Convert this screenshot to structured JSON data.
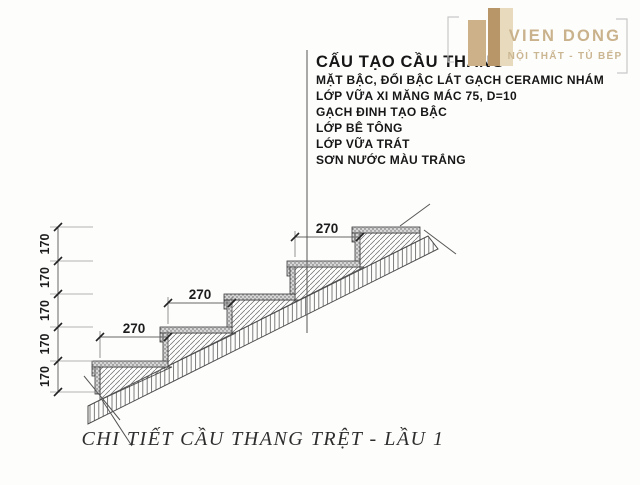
{
  "header": {
    "title": "CẤU TẠO CẦU THANG",
    "spec_lines": [
      "MẶT BẬC, ĐỐI BẬC LÁT GẠCH CERAMIC NHÁM",
      "LỚP VỮA XI MĂNG MÁC 75, D=10",
      "GẠCH ĐINH TẠO BẬC",
      "LỚP BÊ TÔNG",
      "LỚP VỮA TRÁT",
      "SƠN NƯỚC MÀU TRẮNG"
    ]
  },
  "logo": {
    "name": "VIEN DONG",
    "tagline": "NỘI THẤT - TỦ BẾP"
  },
  "dimensions": {
    "tread_label": "270",
    "riser_label": "170"
  },
  "caption": "CHI TIẾT CẦU THANG TRỆT - LẦU 1",
  "colors": {
    "brand_beige": "#c9b28c",
    "line_gray": "#5f5f5f",
    "ink": "#1c1c1c"
  }
}
